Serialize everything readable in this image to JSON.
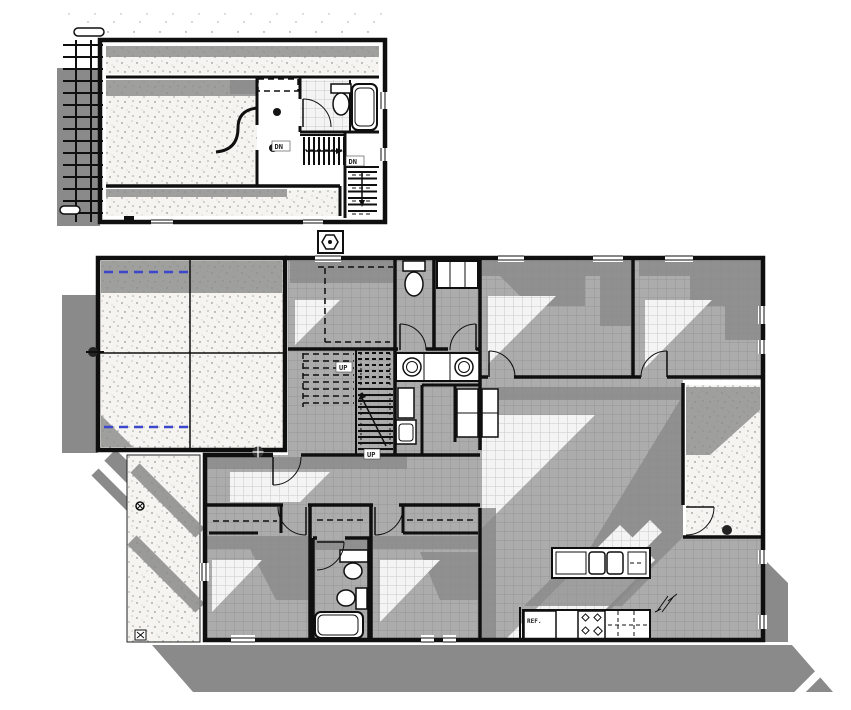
{
  "drawing": {
    "colors": {
      "paper": "#ffffff",
      "wall": "#0f0f0f",
      "shadow": "#8a8a8a",
      "tile_bg": "#acacac",
      "tile_line": "#969696",
      "lit_bg": "#f4f4f4",
      "lit_line": "#c9c9c9",
      "stipple_bg": "#f5f4f0",
      "blue": "#3d47cb",
      "label": "#222222"
    },
    "upper_plan": {
      "stair_labels": [
        {
          "text": "DN"
        },
        {
          "text": "DN"
        }
      ]
    },
    "main_plan": {
      "stair_labels": [
        {
          "text": "UP"
        },
        {
          "text": "UP"
        }
      ],
      "kitchen_labels": [
        {
          "text": "REF."
        }
      ]
    }
  }
}
